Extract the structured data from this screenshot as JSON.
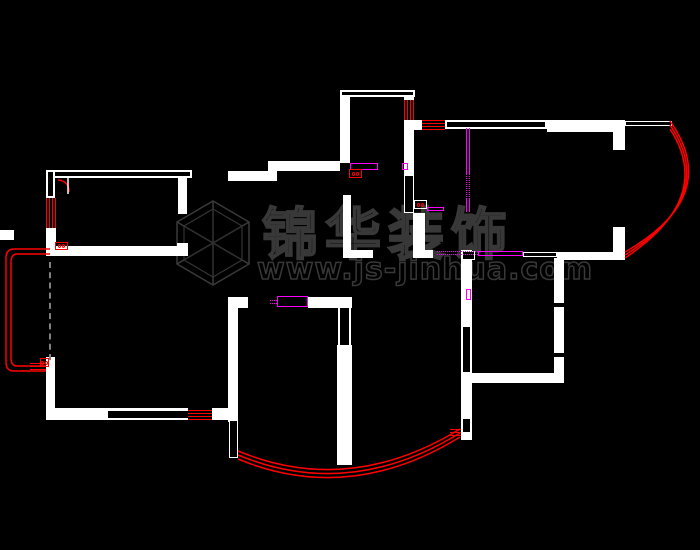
{
  "watermark": {
    "brand": "锦华装饰",
    "url": "www.js-jinhua.com"
  },
  "colors": {
    "background": "#000000",
    "wall": "#ffffff",
    "window_marker": "#ff0000",
    "door_track": "#ff00ff",
    "watermark_gray": "#383838",
    "slider_gray": "#808080"
  },
  "floor_plan": {
    "walls_solid": [
      {
        "x": 178,
        "y": 178,
        "w": 9,
        "h": 36
      },
      {
        "x": 46,
        "y": 228,
        "w": 10,
        "h": 19
      },
      {
        "x": 46,
        "y": 246,
        "w": 142,
        "h": 10
      },
      {
        "x": 177,
        "y": 243,
        "w": 11,
        "h": 13
      },
      {
        "x": 0,
        "y": 230,
        "w": 14,
        "h": 10
      },
      {
        "x": 46,
        "y": 357,
        "w": 9,
        "h": 53
      },
      {
        "x": 46,
        "y": 408,
        "w": 142,
        "h": 12
      },
      {
        "x": 212,
        "y": 408,
        "w": 26,
        "h": 12
      },
      {
        "x": 228,
        "y": 297,
        "w": 10,
        "h": 125
      },
      {
        "x": 228,
        "y": 171,
        "w": 49,
        "h": 10
      },
      {
        "x": 268,
        "y": 161,
        "w": 72,
        "h": 10
      },
      {
        "x": 228,
        "y": 297,
        "w": 20,
        "h": 11
      },
      {
        "x": 308,
        "y": 297,
        "w": 37,
        "h": 11
      },
      {
        "x": 337,
        "y": 297,
        "w": 15,
        "h": 11
      },
      {
        "x": 337,
        "y": 345,
        "w": 15,
        "h": 120
      },
      {
        "x": 343,
        "y": 195,
        "w": 8,
        "h": 56
      },
      {
        "x": 343,
        "y": 250,
        "w": 30,
        "h": 8
      },
      {
        "x": 413,
        "y": 213,
        "w": 12,
        "h": 38
      },
      {
        "x": 413,
        "y": 250,
        "w": 20,
        "h": 8
      },
      {
        "x": 340,
        "y": 90,
        "w": 10,
        "h": 73
      },
      {
        "x": 404,
        "y": 90,
        "w": 10,
        "h": 10
      },
      {
        "x": 404,
        "y": 120,
        "w": 10,
        "h": 55
      },
      {
        "x": 414,
        "y": 120,
        "w": 8,
        "h": 10
      },
      {
        "x": 547,
        "y": 120,
        "w": 66,
        "h": 12
      },
      {
        "x": 613,
        "y": 120,
        "w": 12,
        "h": 30
      },
      {
        "x": 557,
        "y": 252,
        "w": 56,
        "h": 8
      },
      {
        "x": 613,
        "y": 227,
        "w": 12,
        "h": 33
      },
      {
        "x": 554,
        "y": 258,
        "w": 10,
        "h": 45
      },
      {
        "x": 554,
        "y": 307,
        "w": 10,
        "h": 46
      },
      {
        "x": 554,
        "y": 357,
        "w": 10,
        "h": 26
      },
      {
        "x": 471,
        "y": 373,
        "w": 92,
        "h": 10
      },
      {
        "x": 461,
        "y": 250,
        "w": 11,
        "h": 190
      }
    ],
    "walls_outline": [
      {
        "x": 46,
        "y": 170,
        "w": 146,
        "h": 8
      },
      {
        "x": 46,
        "y": 170,
        "w": 9,
        "h": 28
      },
      {
        "x": 340,
        "y": 90,
        "w": 75,
        "h": 7
      },
      {
        "x": 445,
        "y": 120,
        "w": 102,
        "h": 9
      },
      {
        "x": 338,
        "y": 306,
        "w": 13,
        "h": 41
      }
    ],
    "thin_outline": [
      {
        "x": 229,
        "y": 420,
        "w": 9,
        "h": 38
      },
      {
        "x": 523,
        "y": 252,
        "w": 34,
        "h": 5
      },
      {
        "x": 625,
        "y": 121,
        "w": 47,
        "h": 5
      },
      {
        "x": 462,
        "y": 251,
        "w": 13,
        "h": 9
      },
      {
        "x": 404,
        "y": 175,
        "w": 10,
        "h": 38
      }
    ],
    "black_openings": [
      {
        "x": 108,
        "y": 411,
        "w": 80,
        "h": 7
      },
      {
        "x": 463,
        "y": 327,
        "w": 7,
        "h": 45
      },
      {
        "x": 463,
        "y": 419,
        "w": 7,
        "h": 13
      }
    ],
    "windows": [
      {
        "x": 46,
        "y": 198,
        "w": 11,
        "h": 30,
        "o": "v"
      },
      {
        "x": 404,
        "y": 100,
        "w": 10,
        "h": 20,
        "o": "v"
      },
      {
        "x": 188,
        "y": 410,
        "w": 24,
        "h": 10,
        "o": "h"
      },
      {
        "x": 422,
        "y": 120,
        "w": 23,
        "h": 10,
        "o": "h"
      },
      {
        "x": 30,
        "y": 363,
        "w": 16,
        "h": 8,
        "o": "h"
      },
      {
        "x": 450,
        "y": 429,
        "w": 11,
        "h": 9,
        "o": "h"
      }
    ],
    "magenta_tracks": [
      {
        "x": 277,
        "y": 296,
        "w": 31,
        "h": 11,
        "cls": "mag-o"
      },
      {
        "x": 270,
        "y": 300,
        "w": 7,
        "h": 4,
        "cls": "mag-dot-h"
      },
      {
        "x": 350,
        "y": 163,
        "w": 28,
        "h": 7,
        "cls": "mag-o"
      },
      {
        "x": 402,
        "y": 163,
        "w": 6,
        "h": 7,
        "cls": "mag-o"
      },
      {
        "x": 466,
        "y": 128,
        "w": 4,
        "h": 45,
        "cls": "mag-solid-v"
      },
      {
        "x": 466,
        "y": 173,
        "w": 4,
        "h": 26,
        "cls": "mag-dot-v"
      },
      {
        "x": 466,
        "y": 199,
        "w": 4,
        "h": 13,
        "cls": "mag-solid-v"
      },
      {
        "x": 427,
        "y": 207,
        "w": 17,
        "h": 4,
        "cls": "mag-o"
      },
      {
        "x": 437,
        "y": 251,
        "w": 41,
        "h": 4,
        "cls": "mag-dot-h"
      },
      {
        "x": 478,
        "y": 251,
        "w": 45,
        "h": 5,
        "cls": "mag-o"
      },
      {
        "x": 466,
        "y": 289,
        "w": 5,
        "h": 11,
        "cls": "mag-o"
      }
    ],
    "switch_symbols": [
      {
        "x": 55,
        "y": 242,
        "w": 13,
        "h": 8,
        "border": "#f00"
      },
      {
        "x": 40,
        "y": 358,
        "w": 9,
        "h": 9,
        "border": "#f00"
      },
      {
        "x": 349,
        "y": 169,
        "w": 13,
        "h": 9,
        "border": "#f00"
      },
      {
        "x": 414,
        "y": 200,
        "w": 13,
        "h": 9,
        "border": "#fff"
      }
    ],
    "slider_dashed_line": {
      "x": 49,
      "y": 262,
      "h": 98
    },
    "arcs_over": [
      {
        "d": "M238,451 Q349,497 460,429",
        "s": "#f00",
        "w": 1.5
      },
      {
        "d": "M238,455 Q349,501 460,433",
        "s": "#f00",
        "w": 1.5
      },
      {
        "d": "M238,459 Q349,505 460,437",
        "s": "#f00",
        "w": 1.5
      },
      {
        "d": "M670,121 Q723,196 625,252",
        "s": "#f00",
        "w": 1.5
      },
      {
        "d": "M670,125 Q719,197 625,255",
        "s": "#f00",
        "w": 1.5
      },
      {
        "d": "M670,129 Q715,198 625,258",
        "s": "#f00",
        "w": 1.5
      },
      {
        "d": "M50,249 L14,249 Q6,249 6,258 L6,362 Q6,371 14,371 L46,371",
        "s": "#f00",
        "w": 1.5
      },
      {
        "d": "M50,254 L17,254 Q11,254 11,262 L11,358 Q11,366 17,366 L46,366",
        "s": "#f00",
        "w": 1.5
      },
      {
        "d": "M58,180 Q69,181 69,192",
        "s": "#f00",
        "w": 1.5
      },
      {
        "d": "M68,178 L68,194",
        "s": "#fff",
        "w": 1.5
      }
    ],
    "logo_cube_paths": [
      {
        "d": "M213,201 L249,222 L249,264 L213,285 L177,264 L177,222 Z",
        "s": "#3a3a3a",
        "w": 1.5
      },
      {
        "d": "M213,209 L242,226 L242,260 L213,277 L184,260 L184,226 Z",
        "s": "#333333",
        "w": 1.2
      },
      {
        "d": "M213,201 L213,285 M177,222 L249,264 M249,222 L177,264",
        "s": "#3a3a3a",
        "w": 1.5
      },
      {
        "d": "M213,209 L213,277 M184,226 L242,260 M242,226 L184,260",
        "s": "#2d2d2d",
        "w": 1
      }
    ]
  }
}
